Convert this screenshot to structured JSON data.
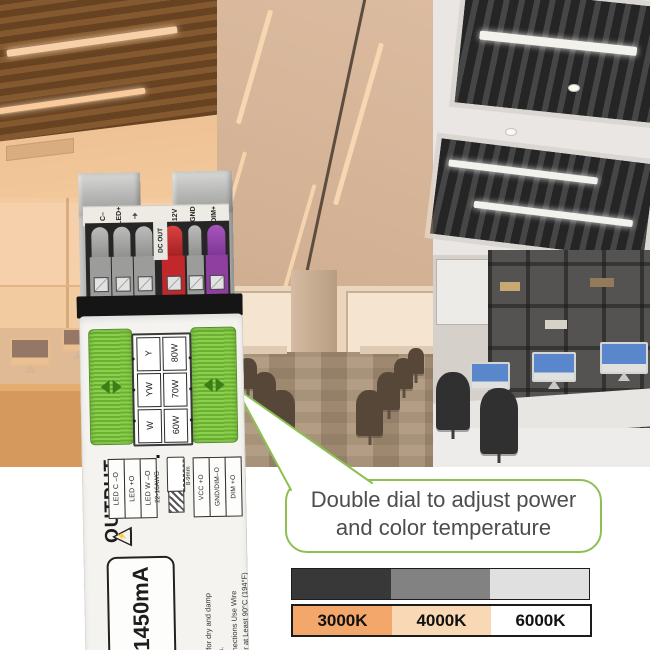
{
  "product": {
    "top_terminal_labels": [
      "C–",
      "LED+",
      "⏚",
      "12V",
      "GND",
      "DIM+"
    ],
    "dc_out_label": "DC OUT",
    "dial": {
      "ct_options": [
        "Y",
        "YW",
        "W"
      ],
      "power_options": [
        "80W",
        "70W",
        "60W"
      ]
    },
    "output_title": "OUTPUT",
    "out_left_terminals": [
      "LED C –O",
      "LED  +O",
      "LED W –O"
    ],
    "wire_gauge": "22-16AWG",
    "strip_length": "8-9mm",
    "out_right_terminals": [
      "VCC  +O",
      "GND/DIM–O",
      "DIM  +O"
    ],
    "warning_symbol": "⚡",
    "current_rating": "1450mA",
    "fine_print": [
      "Suitable for dry and damp",
      "locations.",
      "For Connections Use Wire",
      "Rated for at Least 90°C (194°F)"
    ]
  },
  "callout": {
    "line1": "Double dial to adjust power",
    "line2": "and color temperature",
    "accent_color": "#8cc152"
  },
  "legend": {
    "gray_segments": [
      "#383838",
      "#828282",
      "#e0e0e0"
    ],
    "temp_segments": [
      {
        "label": "3000K",
        "color": "#f4a76b"
      },
      {
        "label": "4000K",
        "color": "#f9d8b6"
      },
      {
        "label": "6000K",
        "color": "#ffffff"
      }
    ]
  }
}
